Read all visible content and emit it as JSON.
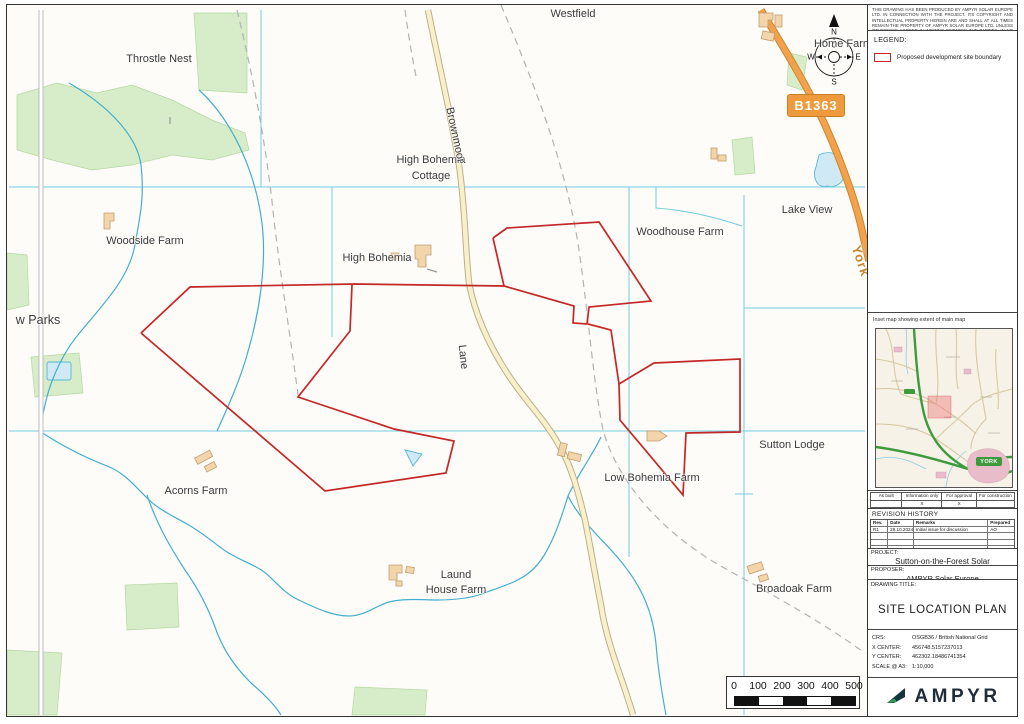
{
  "map": {
    "road_badge": "B1363",
    "compass": {
      "n": "N",
      "e": "E",
      "s": "S",
      "w": "W"
    },
    "scale_bar": {
      "ticks": [
        "0",
        "100",
        "200",
        "300",
        "400",
        "500"
      ]
    },
    "labels": [
      {
        "id": "westfield",
        "text": "Westfield",
        "x": 566,
        "y": 9
      },
      {
        "id": "throstle-nest",
        "text": "Throstle Nest",
        "x": 152,
        "y": 54
      },
      {
        "id": "home-farm",
        "text": "Home Farm",
        "x": 836,
        "y": 39
      },
      {
        "id": "high-bohemia-cottage-line1",
        "text": "High Bohemia",
        "x": 424,
        "y": 155
      },
      {
        "id": "high-bohemia-cottage-line2",
        "text": "Cottage",
        "x": 424,
        "y": 171
      },
      {
        "id": "brownmoor-lane-part1",
        "text": "Brownmoor",
        "x": 448,
        "y": 130,
        "rot": 78
      },
      {
        "id": "brownmoor-lane-part2",
        "text": "Lane",
        "x": 456,
        "y": 352,
        "rot": 84
      },
      {
        "id": "woodside-farm",
        "text": "Woodside Farm",
        "x": 138,
        "y": 236
      },
      {
        "id": "high-bohemia",
        "text": "High Bohemia",
        "x": 370,
        "y": 253
      },
      {
        "id": "woodhouse-farm",
        "text": "Woodhouse Farm",
        "x": 673,
        "y": 227
      },
      {
        "id": "lake-view",
        "text": "Lake View",
        "x": 800,
        "y": 205
      },
      {
        "id": "york-road-destination",
        "text": "York",
        "x": 854,
        "y": 256,
        "rot": 72,
        "size": 13,
        "color": "#c8872e",
        "bold": true
      },
      {
        "id": "low-parks",
        "text": "w Parks",
        "x": 31,
        "y": 315,
        "size": 12.5
      },
      {
        "id": "sutton-lodge",
        "text": "Sutton Lodge",
        "x": 785,
        "y": 440
      },
      {
        "id": "low-bohemia-farm",
        "text": "Low Bohemia Farm",
        "x": 645,
        "y": 473
      },
      {
        "id": "acorns-farm",
        "text": "Acorns Farm",
        "x": 189,
        "y": 486
      },
      {
        "id": "laund-house-farm-line1",
        "text": "Laund",
        "x": 449,
        "y": 570
      },
      {
        "id": "laund-house-farm-line2",
        "text": "House Farm",
        "x": 449,
        "y": 585
      },
      {
        "id": "broadoak-farm",
        "text": "Broadoak Farm",
        "x": 787,
        "y": 584
      }
    ],
    "colors": {
      "site_boundary": "#c42727",
      "b_road": "#f09a3e",
      "minor_road_fill": "#f7f0cb",
      "water": "#43aecd",
      "woodland": "#d7ecc8"
    }
  },
  "panel": {
    "disclaimer": "THIS DRAWING HAS BEEN PRODUCED BY AMPYR SOLAR EUROPE LTD. IN CONNECTION WITH THE PROJECT. ITS COPYRIGHT AND INTELLECTUAL PROPERTY HEREIN ARE AND SHALL AT ALL TIMES REMAIN THE PROPERTY OF AMPYR SOLAR EUROPE LTD. UNLESS OTHERWISE AGREED IN WRITING BETWEEN THE PARTIES. IN NO EVENT SHALL THE THIRD PARTY USE THE DRAWING FOR ANY PURPOSE OTHER THAN THOSE IN RELATION TO THE PROJECT WITHOUT THE PRIOR WRITTEN PERMISSION OF AMPYR SOLAR EUROPE LTD.",
    "legend": {
      "title": "LEGEND:",
      "items": [
        {
          "label": "Proposed development site boundary",
          "color": "#c42727"
        }
      ]
    },
    "inset": {
      "caption": "Inset map showing extent of main map",
      "city_badge": "YORK"
    },
    "status": {
      "columns": [
        "As built",
        "Information only",
        "For approval",
        "For construction"
      ],
      "values": [
        "",
        "X",
        "X",
        ""
      ]
    },
    "revision": {
      "title": "REVISION HISTORY",
      "columns": [
        "Rev.",
        "Date",
        "Remarks",
        "Prepared by"
      ],
      "rows": [
        [
          "R1",
          "29.10.2024",
          "Initial issue for discussion",
          "AO"
        ]
      ],
      "empty_rows": 3
    },
    "project": {
      "label": "PROJECT:",
      "value": "Sutton-on-the-Forest Solar"
    },
    "proposer": {
      "label": "PROPOSER:",
      "value": "AMPYR Solar Europe"
    },
    "drawing_title": {
      "label": "DRAWING TITLE:",
      "value": "SITE LOCATION PLAN"
    },
    "meta": {
      "rows": [
        [
          "CRS:",
          "OSGB36 / British National Grid"
        ],
        [
          "X CENTER:",
          "456748.5157237013"
        ],
        [
          "Y CENTER:",
          "462302.18486741354"
        ],
        [
          "SCALE @ A3:",
          "1:10,000"
        ]
      ]
    },
    "logo_text": "AMPYR",
    "logo_colors": {
      "dark": "#16343c",
      "green": "#2f9e62"
    }
  }
}
